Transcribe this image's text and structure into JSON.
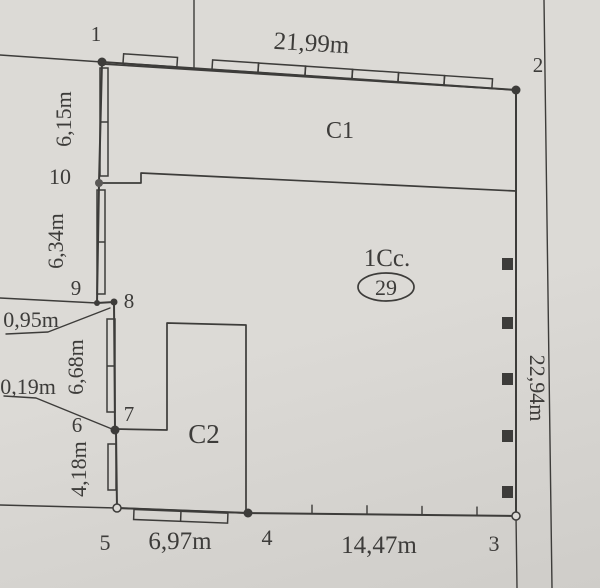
{
  "colors": {
    "paper": "#dcdad6",
    "paper_edge": "#cfcdc9",
    "ink": "#3d3c3a"
  },
  "plan": {
    "zone_label": "1Cc.",
    "parcel_number": "29",
    "buildings": {
      "c1": "C1",
      "c2": "C2"
    },
    "points": {
      "p1": "1",
      "p2": "2",
      "p3": "3",
      "p4": "4",
      "p5": "5",
      "p6": "6",
      "p7": "7",
      "p8": "8",
      "p9": "9",
      "p10": "10"
    },
    "dimensions": {
      "side_1_2": "21,99m",
      "side_2_3": "22,94m",
      "side_4_3": "14,47m",
      "side_5_4": "6,97m",
      "side_6_5": "4,18m",
      "side_7_6": "0,19m",
      "side_8_7": "6,68m",
      "side_9_8": "0,95m",
      "side_10_9": "6,34m",
      "side_1_10": "6,15m"
    }
  }
}
